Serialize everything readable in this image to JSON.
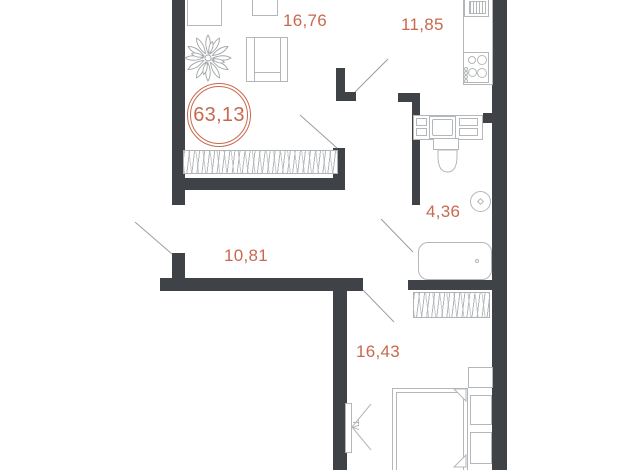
{
  "plan": {
    "total_area": "63,13",
    "rooms": {
      "living": {
        "area": "16,76"
      },
      "kitchen": {
        "area": "11,85"
      },
      "bathroom": {
        "area": "4,36"
      },
      "hallway": {
        "area": "10,81"
      },
      "bedroom": {
        "area": "16,43"
      }
    },
    "bedroom_tv_label": "TV",
    "colors": {
      "wall": "#3f4347",
      "accent": "#c8694f",
      "furniture_line": "#b4b7b9"
    }
  }
}
